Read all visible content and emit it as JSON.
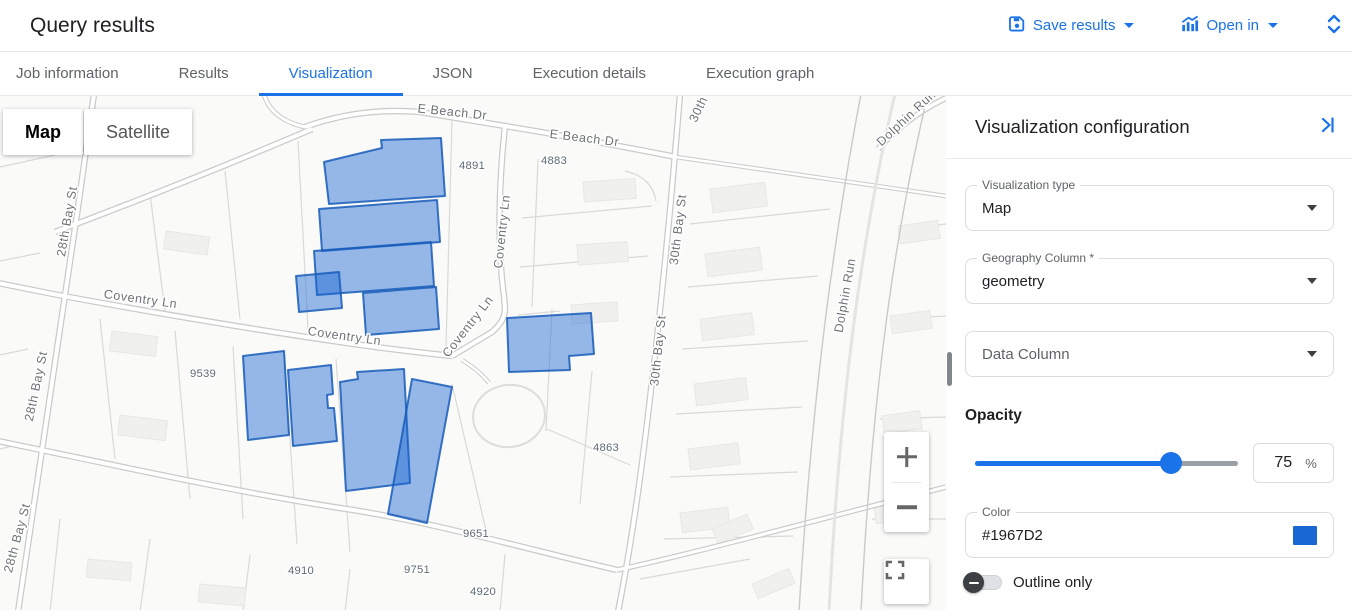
{
  "header": {
    "title": "Query results",
    "save_results_label": "Save results",
    "open_in_label": "Open in"
  },
  "tabs": {
    "items": [
      {
        "label": "Job information"
      },
      {
        "label": "Results"
      },
      {
        "label": "Visualization"
      },
      {
        "label": "JSON"
      },
      {
        "label": "Execution details"
      },
      {
        "label": "Execution graph"
      }
    ],
    "active_tab": "Visualization"
  },
  "map": {
    "type_control": {
      "map_label": "Map",
      "satellite_label": "Satellite",
      "active": "Map"
    },
    "street_labels": [
      {
        "text": "E Beach Dr"
      },
      {
        "text": "E Beach Dr"
      },
      {
        "text": "Coventry Ln"
      },
      {
        "text": "Coventry Ln"
      },
      {
        "text": "Coventry Ln"
      },
      {
        "text": "Coventry Ln"
      },
      {
        "text": "30th Bay St"
      },
      {
        "text": "30th Bay St"
      },
      {
        "text": "30th"
      },
      {
        "text": "Dolphin Run"
      },
      {
        "text": "Dolphin Run"
      },
      {
        "text": "28th Bay St"
      },
      {
        "text": "28th Bay St"
      },
      {
        "text": "28th Bay St"
      }
    ],
    "house_numbers": [
      {
        "text": "4891"
      },
      {
        "text": "4883"
      },
      {
        "text": "9539"
      },
      {
        "text": "4863"
      },
      {
        "text": "9651"
      },
      {
        "text": "9751"
      },
      {
        "text": "4910"
      },
      {
        "text": "4920"
      }
    ],
    "feature_color": "#1967D2"
  },
  "panel": {
    "title": "Visualization configuration",
    "visualization_type": {
      "label": "Visualization type",
      "value": "Map"
    },
    "geography_column": {
      "label": "Geography Column *",
      "value": "geometry"
    },
    "data_column": {
      "label": "Data Column"
    },
    "opacity": {
      "label": "Opacity",
      "value": "75",
      "unit": "%"
    },
    "color": {
      "label": "Color",
      "value": "#1967D2",
      "swatch_style": "background:#1967D2"
    },
    "outline_only": {
      "label": "Outline only",
      "enabled": false
    }
  },
  "colors": {
    "accent": "#1a73e8",
    "feature": "#1967D2"
  },
  "icons": {
    "save": "floppy-disk",
    "open_in": "bar-chart",
    "header_expand": "unfold-chevrons",
    "panel_collapse": "chevron-right-bar",
    "dropdown_caret": "▾",
    "zoom_in": "+",
    "zoom_out": "−",
    "fullscreen": "corner-brackets",
    "toggle_off": "minus-in-circle"
  }
}
